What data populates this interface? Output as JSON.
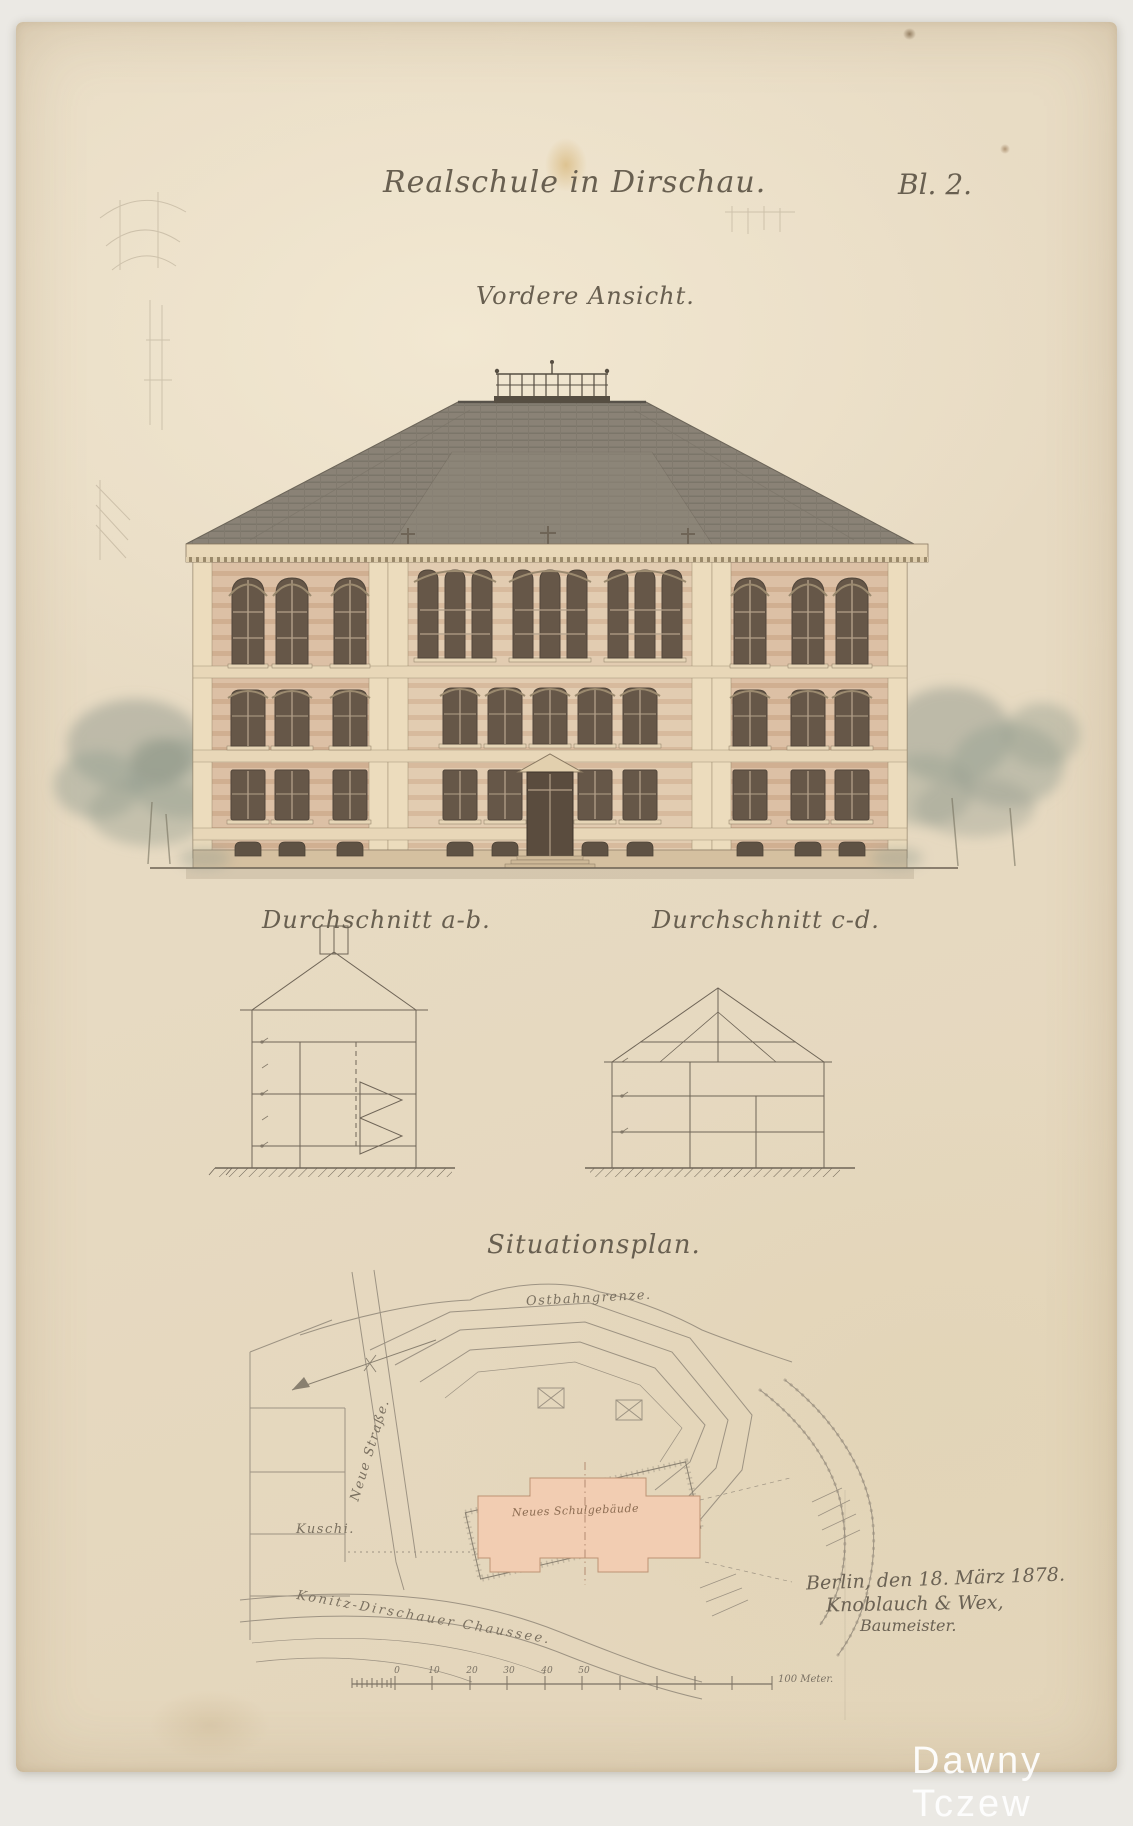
{
  "document": {
    "title": "Realschule in Dirschau.",
    "sheet_no": "Bl. 2.",
    "watermark": "Dawny Tczew"
  },
  "sections": {
    "elevation_title": "Vordere Ansicht.",
    "section_ab_title": "Durchschnitt a-b.",
    "section_cd_title": "Durchschnitt c-d.",
    "siteplan_title": "Situationsplan."
  },
  "siteplan": {
    "boundary_label": "Ostbahngrenze.",
    "street_label": "Neue Straße.",
    "plot_label": "Kuschi.",
    "road_label": "Konitz-Dirschauer Chaussee.",
    "building_label": "Neues Schulgebäude"
  },
  "signature": {
    "line1": "Berlin, den 18. März 1878.",
    "line2": "Knoblauch & Wex,",
    "line3": "Baumeister."
  },
  "scalebar": {
    "tick_labels": [
      "0",
      "10",
      "20",
      "30",
      "40",
      "50"
    ],
    "end_label": "100 Meter."
  },
  "colors": {
    "paper": "#e8dcc4",
    "scan_background": "#ebe9e4",
    "ink": "#6b6254",
    "drawing_line": "#958b7a",
    "facade": "#dcc0a5",
    "roof_slate": "#8a8276",
    "window_glass": "#665748",
    "site_building_fill": "#f3cdb2",
    "watermark": "#ffffff"
  }
}
